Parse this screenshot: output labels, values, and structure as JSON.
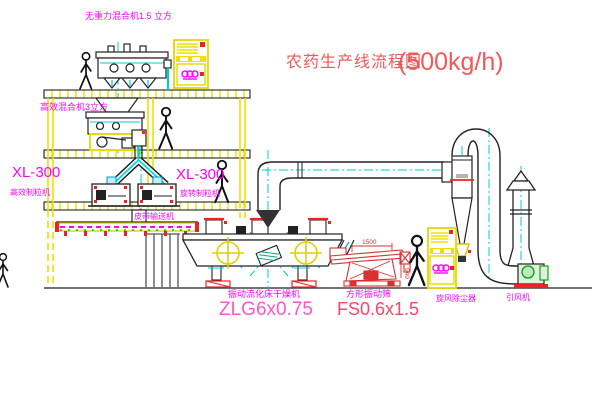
{
  "diagram": {
    "title": {
      "cn": "农药生产线流程图",
      "capacity": "(500kg/h)"
    },
    "labels": {
      "top_mixer": "无重力混合机1.5 立方",
      "mid_mixer": "高效混合机3立方",
      "granulator_model_left": "XL-300",
      "granulator_left": "高效制粒机",
      "granulator_model_right": "XL-300",
      "granulator_right": "旋转制粒机",
      "belt_conveyor": "皮带输送机",
      "dryer": "振动流化床干燥机",
      "dryer_model": "ZLG6x0.75",
      "sieve": "方形振动筛",
      "sieve_model": "FS0.6x1.5",
      "cyclone": "旋风除尘器",
      "fan": "引风机"
    },
    "dimensions": {
      "sieve_length": "1500",
      "sieve_height": "940"
    },
    "colors": {
      "structure_yellow": "#f0df00",
      "label_magenta": "#ff00ff",
      "title_red": "#f25858",
      "model_pink": "#ff55cc",
      "model_red": "#ff4466",
      "dimension_red": "#d93030",
      "centerline_cyan": "#00cccc",
      "accent_red": "#ee2222",
      "fan_green": "#00a000"
    }
  }
}
